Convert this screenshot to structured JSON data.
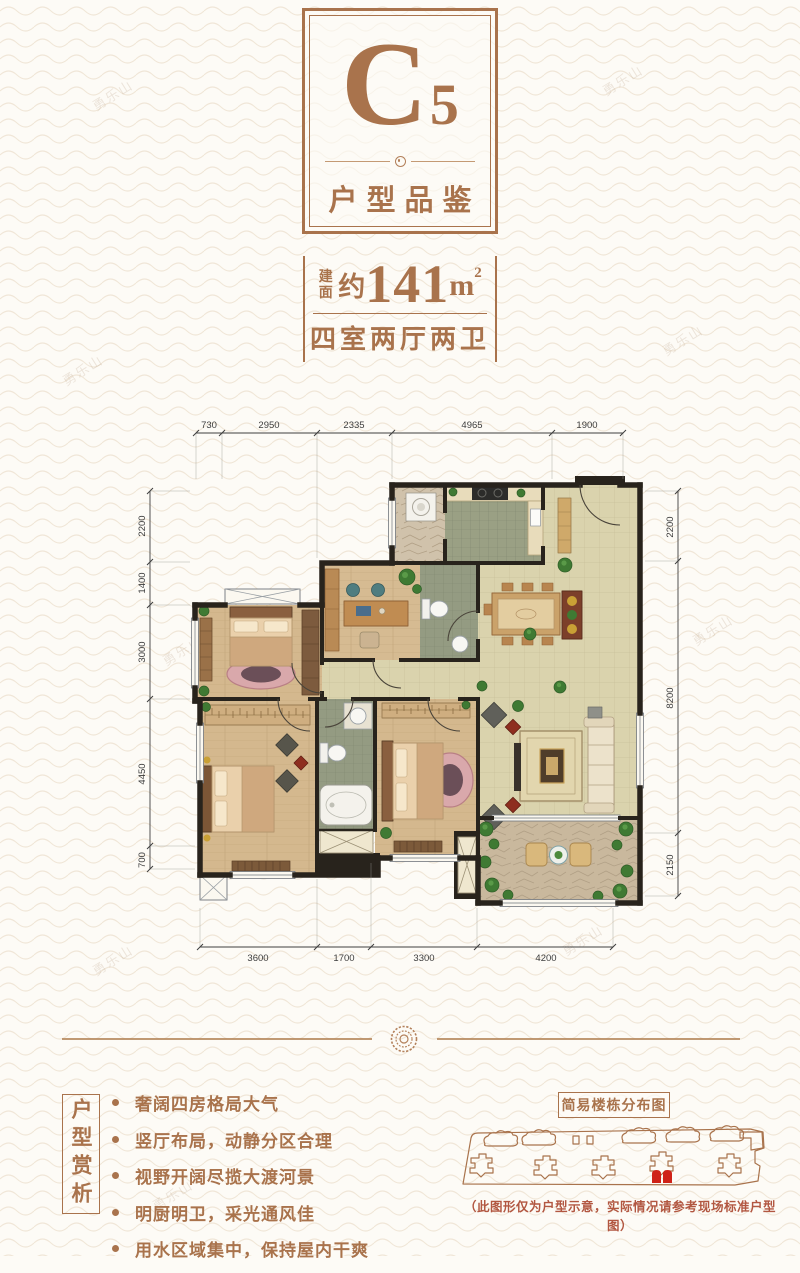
{
  "watermark": "勇乐山",
  "theme": {
    "accent": "#a9734c",
    "disclaimer_red": "#b25741",
    "building_highlight_red": "#cf2218",
    "wall": "#28231c",
    "wood_floor": "#d4b991",
    "tile_floor": "#dad3ad",
    "bath_floor": "#949b82",
    "stone_floor": "#cfc1ab"
  },
  "header": {
    "code_letter": "C",
    "code_number": "5",
    "subtitle": "户型品鉴"
  },
  "area": {
    "label": "建面",
    "approx": "约",
    "value": "141",
    "unit": "m",
    "sup": "2",
    "rooms": "四室两厅两卫"
  },
  "floorplan": {
    "dims_top": [
      "730",
      "2950",
      "2335",
      "4965",
      "1900"
    ],
    "dims_left": [
      "2200",
      "1400",
      "3000",
      "4450",
      "700"
    ],
    "dims_right": [
      "2200",
      "8200",
      "2150"
    ],
    "dims_bottom": [
      "3600",
      "1700",
      "3300",
      "4200"
    ]
  },
  "analysis": {
    "title": "户型赏析",
    "bullets": [
      "奢阔四房格局大气",
      "竖厅布局，动静分区合理",
      "视野开阔尽揽大渡河景",
      "明厨明卫，采光通风佳",
      "用水区域集中，保持屋内干爽"
    ]
  },
  "distribution": {
    "title": "简易楼栋分布图",
    "disclaimer": "（此图形仅为户型示意，实际情况请参考现场标准户型图）"
  }
}
